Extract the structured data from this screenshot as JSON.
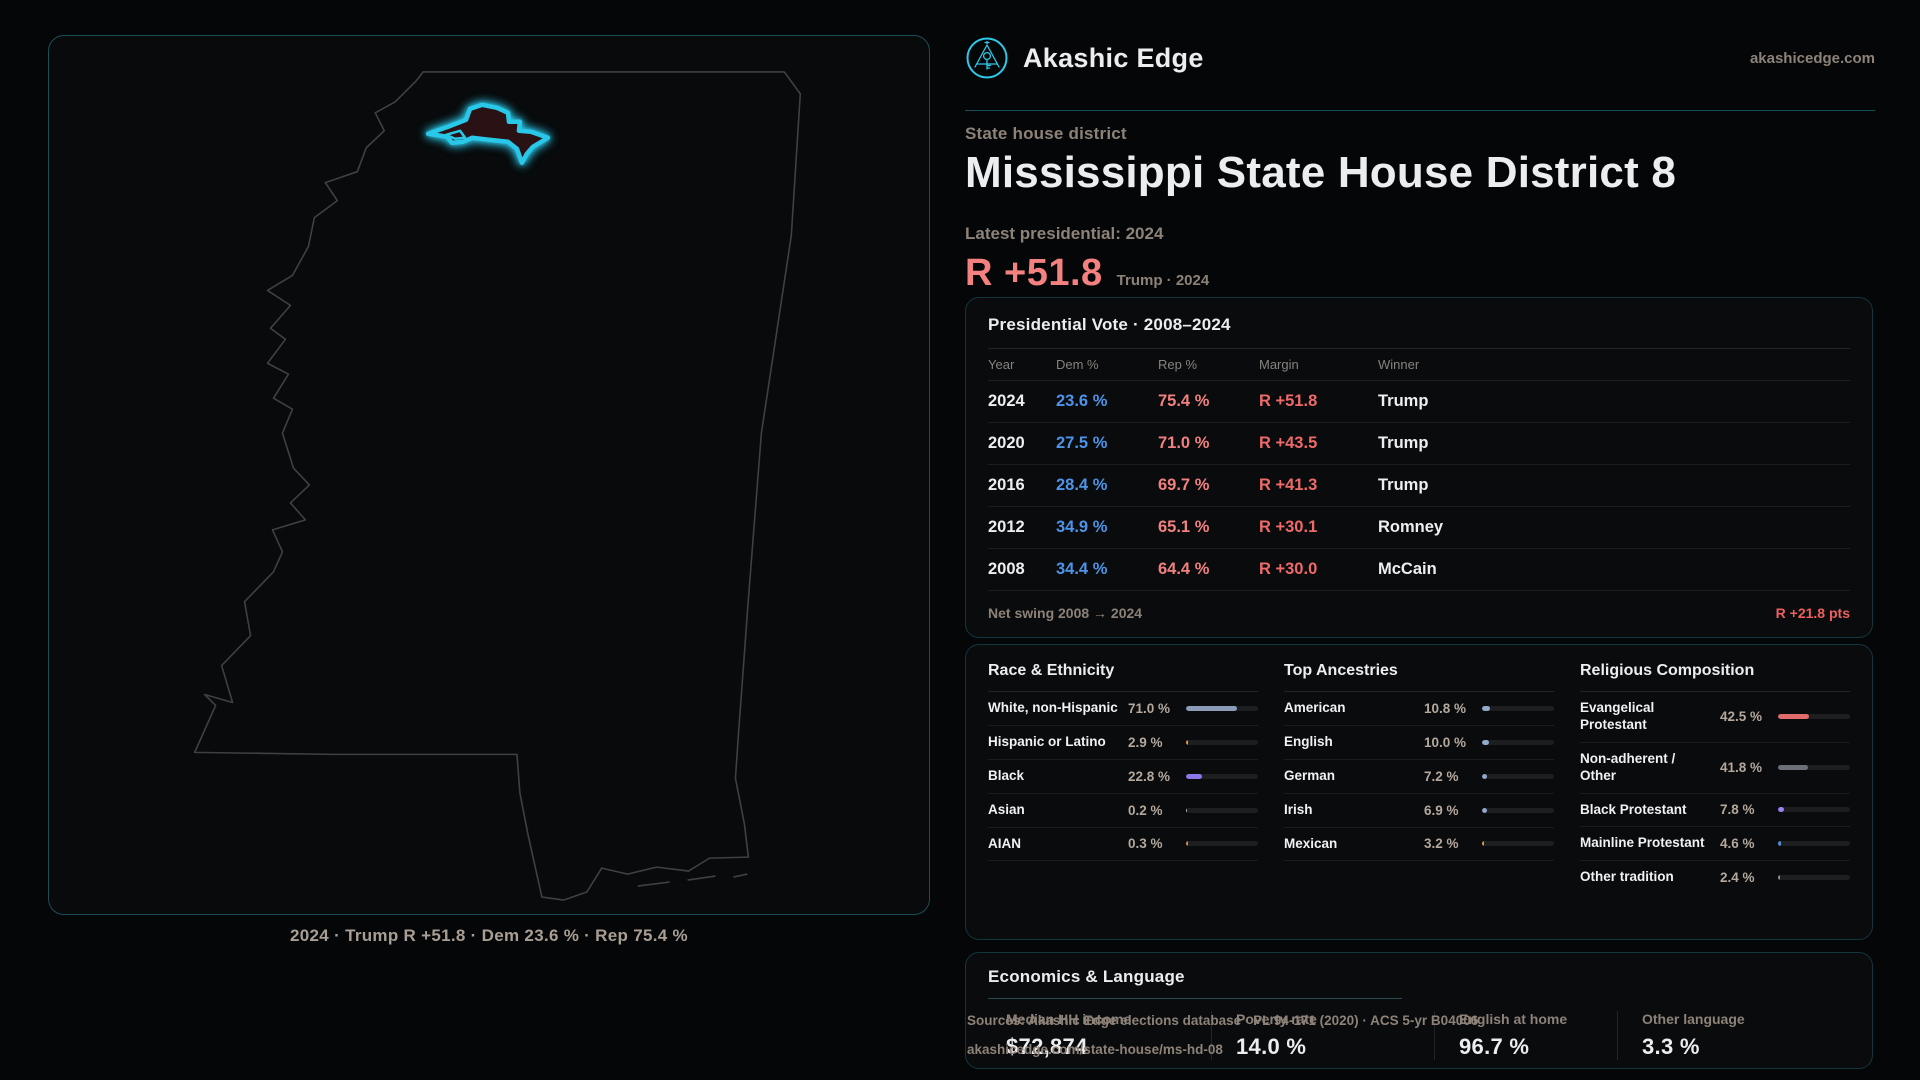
{
  "brand": {
    "name": "Akashic Edge",
    "domain": "akashicedge.com"
  },
  "page": {
    "kicker": "State house district",
    "title": "Mississippi State House District 8",
    "latest_label": "Latest presidential: 2024",
    "big_stat": {
      "value": "R +51.8",
      "sub": "Trump · 2024"
    },
    "map_caption": "2024 · Trump R +51.8 · Dem 23.6 % · Rep 75.4 %"
  },
  "colors": {
    "accent_cyan": "#29c7e8",
    "dem_blue": "#4d94e8",
    "rep_red": "#f28080",
    "margin_red": "#ee6a6a",
    "big_stat_red": "#f58080"
  },
  "presidential_table": {
    "title": "Presidential Vote · 2008–2024",
    "columns": [
      "Year",
      "Dem %",
      "Rep %",
      "Margin",
      "Winner"
    ],
    "rows": [
      {
        "year": "2024",
        "dem": "23.6 %",
        "rep": "75.4 %",
        "margin": "R +51.8",
        "winner": "Trump"
      },
      {
        "year": "2020",
        "dem": "27.5 %",
        "rep": "71.0 %",
        "margin": "R +43.5",
        "winner": "Trump"
      },
      {
        "year": "2016",
        "dem": "28.4 %",
        "rep": "69.7 %",
        "margin": "R +41.3",
        "winner": "Trump"
      },
      {
        "year": "2012",
        "dem": "34.9 %",
        "rep": "65.1 %",
        "margin": "R +30.1",
        "winner": "Romney"
      },
      {
        "year": "2008",
        "dem": "34.4 %",
        "rep": "64.4 %",
        "margin": "R +30.0",
        "winner": "McCain"
      }
    ],
    "footer_label": "Net swing 2008 → 2024",
    "footer_value": "R +21.8 pts"
  },
  "demographics": {
    "race": {
      "title": "Race & Ethnicity",
      "rows": [
        {
          "label": "White, non-Hispanic",
          "value": "71.0 %",
          "pct": 71.0,
          "color": "#8b9cb8"
        },
        {
          "label": "Hispanic or Latino",
          "value": "2.9 %",
          "pct": 2.9,
          "color": "#e09a30"
        },
        {
          "label": "Black",
          "value": "22.8 %",
          "pct": 22.8,
          "color": "#8d78ea"
        },
        {
          "label": "Asian",
          "value": "0.2 %",
          "pct": 0.2,
          "color": "#b0b4ba"
        },
        {
          "label": "AIAN",
          "value": "0.3 %",
          "pct": 0.3,
          "color": "#d98c4a"
        }
      ]
    },
    "ancestries": {
      "title": "Top Ancestries",
      "rows": [
        {
          "label": "American",
          "value": "10.8 %",
          "pct": 10.8,
          "color": "#93a9c9"
        },
        {
          "label": "English",
          "value": "10.0 %",
          "pct": 10.0,
          "color": "#93a9c9"
        },
        {
          "label": "German",
          "value": "7.2 %",
          "pct": 7.2,
          "color": "#93a9c9"
        },
        {
          "label": "Irish",
          "value": "6.9 %",
          "pct": 6.9,
          "color": "#93a9c9"
        },
        {
          "label": "Mexican",
          "value": "3.2 %",
          "pct": 3.2,
          "color": "#e0a030"
        }
      ]
    },
    "religion": {
      "title": "Religious Composition",
      "rows": [
        {
          "label": "Evangelical Protestant",
          "value": "42.5 %",
          "pct": 42.5,
          "color": "#e26b6b"
        },
        {
          "label": "Non-adherent / Other",
          "value": "41.8 %",
          "pct": 41.8,
          "color": "#6b7078"
        },
        {
          "label": "Black Protestant",
          "value": "7.8 %",
          "pct": 7.8,
          "color": "#9b82f0"
        },
        {
          "label": "Mainline Protestant",
          "value": "4.6 %",
          "pct": 4.6,
          "color": "#4e8fd9"
        },
        {
          "label": "Other tradition",
          "value": "2.4 %",
          "pct": 2.4,
          "color": "#8b9199"
        }
      ]
    }
  },
  "economics": {
    "title": "Economics & Language",
    "stats": [
      {
        "label": "Median HH income",
        "value": "$72,874"
      },
      {
        "label": "Poverty rate",
        "value": "14.0 %"
      },
      {
        "label": "English at home",
        "value": "96.7 %"
      },
      {
        "label": "Other language",
        "value": "3.3 %"
      }
    ]
  },
  "footer": {
    "line1": "Sources: Akashic Edge elections database · PL 94-171 (2020) · ACS 5-yr B04006",
    "line2": "akashicedge.com/state-house/ms-hd-08"
  }
}
